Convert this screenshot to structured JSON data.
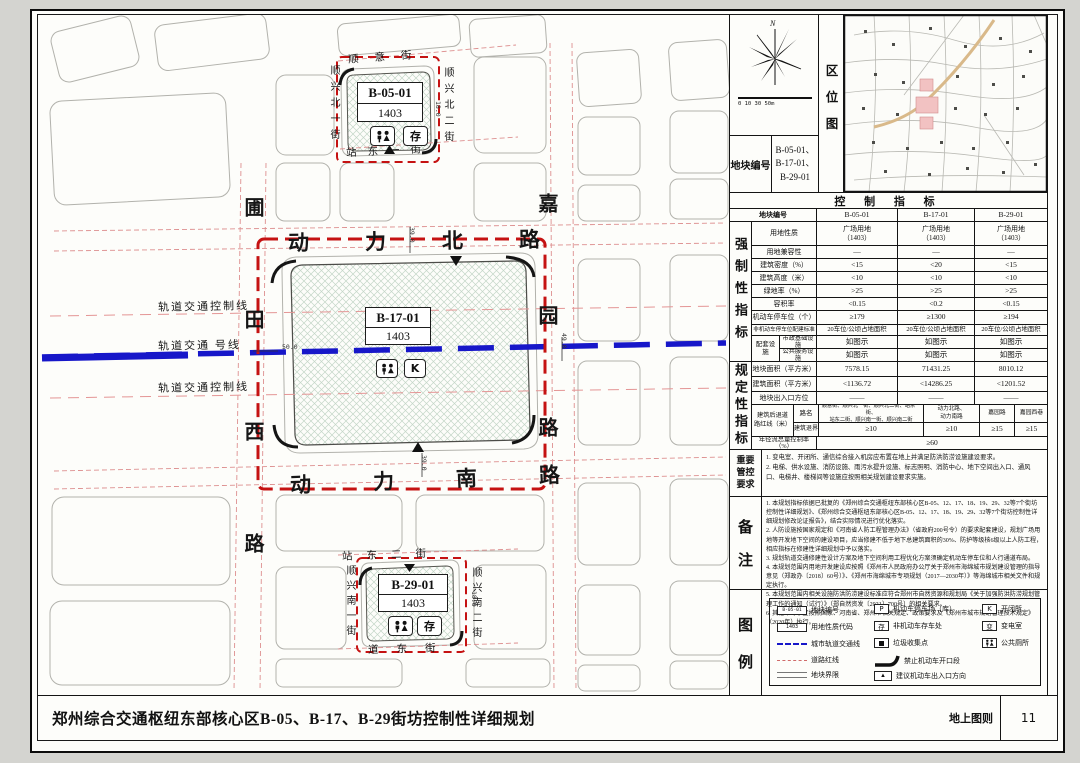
{
  "titlebar": {
    "title": "郑州综合交通枢纽东部核心区B-05、B-17、B-29街坊控制性详细规划",
    "sheet_label": "地上图则",
    "page": "11"
  },
  "compass": {
    "north_label": "N",
    "scale_text": "0  10  30  50m"
  },
  "location": {
    "panel_label": "区位图"
  },
  "block_no": {
    "label": "地块编号",
    "values": "B-05-01、\nB-17-01、\nB-29-01"
  },
  "control": {
    "title": "控  制  指  标",
    "header_label": "地块编号",
    "c1": "B-05-01",
    "c2": "B-17-01",
    "c3": "B-29-01",
    "mandatory_label": "强制性指标",
    "regulatory_label": "规定性指标",
    "r_use": {
      "label": "用地性质",
      "v1": "广场用地\n（1403）",
      "v2": "广场用地\n（1403）",
      "v3": "广场用地\n（1403）"
    },
    "r_compat": {
      "label": "用地兼容性",
      "v1": "—",
      "v2": "—",
      "v3": "—"
    },
    "r_density": {
      "label": "建筑密度（%）",
      "v1": "<15",
      "v2": "<20",
      "v3": "<15"
    },
    "r_height": {
      "label": "建筑高度（米）",
      "v1": "<10",
      "v2": "<10",
      "v3": "<10"
    },
    "r_green": {
      "label": "绿地率（%）",
      "v1": ">25",
      "v2": ">25",
      "v3": ">25"
    },
    "r_far": {
      "label": "容积率",
      "v1": "<0.15",
      "v2": "<0.2",
      "v3": "<0.15"
    },
    "r_parking": {
      "label": "机动车停车位（个）",
      "v1": "≥179",
      "v2": "≥1300",
      "v3": "≥194"
    },
    "r_bike": {
      "label": "非机动车停车位配建标准",
      "v1": "20车位/公顷占地面积",
      "v2": "20车位/公顷占地面积",
      "v3": "20车位/公顷占地面积"
    },
    "peitao_label": "配套设施",
    "r_muni": {
      "label": "市政基础设施",
      "v1": "如图示",
      "v2": "如图示",
      "v3": "如图示"
    },
    "r_public": {
      "label": "公共服务设施",
      "v1": "如图示",
      "v2": "如图示",
      "v3": "如图示"
    },
    "r_area": {
      "label": "地块面积（平方米）",
      "v1": "7578.15",
      "v2": "71431.25",
      "v3": "8010.12"
    },
    "r_floor": {
      "label": "建筑面积（平方米）",
      "v1": "<1136.72",
      "v2": "<14286.25",
      "v3": "<1201.52"
    },
    "r_access": {
      "label": "地块出入口方位",
      "v1": "——",
      "v2": "——",
      "v3": "——"
    },
    "setback_label": "建筑后退道路红线（米）",
    "setback_r1": "路名",
    "setback_r2": "建筑退界",
    "roads1": "顺意街、顺兴北一街、顺兴北二街、站东一街、\n站东二街、顺兴南一街、顺兴南二街",
    "roads2": "动力北路、\n动力南路",
    "roads3": "嘉园路",
    "roads4": "嘉园西巷",
    "sb1": "≥10",
    "sb2": "≥10",
    "sb3": "≥15",
    "sb4": "≥15",
    "runoff_label": "年径流总量控制率（%）",
    "runoff_value": "≥60"
  },
  "requirements": {
    "l1": "重要",
    "l2": "管控",
    "l3": "要求",
    "text": "1. 变电室、开闭所、通信综合接入机房应布置在地上并满足防洪防涝设施建设要求。\n2. 电梯、供水设施、消防设施、雨污水提升设施、标志照明、消防中心、地下空间出入口、通风口、电梯井、楼梯间等设施应按照相关规划建设要求实施。"
  },
  "notes": {
    "l1": "备",
    "l2": "注",
    "text": "1. 本规划指标依据已批复的《郑州综合交通枢纽东部核心区B-05、12、17、18、19、29、32等7个街坊控制性详细规划》、《郑州综合交通枢纽东部核心区B-05、12、17、18、19、29、32等7个街坊控制性详细规划修改论证报告》，结合实际情况进行优化落实。\n2. 人防设施按国家规定和《河南省人防工程管理办法》（省政府200号令）的要求配套建设，规划广场用地等开发地下空间的建设项目，应当修建不低于地下总建筑面积的30%、防护等级核6级以上人防工程，相应指标在修建性详细规划中予以落实。\n3. 规划轨道交通修建性设计方案及地下空间利用工程优化方案须确定机动车停车位和人行通道布局。\n4. 本规划范围内用地开发建设应按照《郑州市人民政府办公厅关于郑州市海绵城市规划建设管理的指导意见（郑政办〔2018〕60号）》、《郑州市海绵城市专项规划（2017—2030年）》等海绵城市相关文件和规定执行。\n5. 本规划范围内相关设施防洪防涝建设标准应符合郑州市自然资源和规划局《关于加强防洪防涝规划管理工作的通知（试行）》（郑自然资发〔2021〕700号）的相关要求。\n6. 其他未尽事宜按照国家、河南省、郑州市相关规定、政策要求及《郑州市城市规划管理技术规定》（2020年）执行。"
  },
  "legend": {
    "l1": "图",
    "l2": "例",
    "b_id": {
      "glyph": "B-05-01",
      "label": "地块编号"
    },
    "b_code": {
      "glyph": "1403",
      "label": "用地性质代码"
    },
    "rail": {
      "label": "城市轨道交通线"
    },
    "redline": {
      "label": "道路红线"
    },
    "boundary": {
      "label": "地块界限"
    },
    "park": {
      "glyph": "P",
      "label": "机动车停车场（库）"
    },
    "bike": {
      "glyph": "存",
      "label": "非机动车存车处"
    },
    "trash": {
      "label": "垃圾收集点"
    },
    "noopen": {
      "label": "禁止机动车开口段"
    },
    "entry": {
      "glyph": "▲",
      "label": "建议机动车出入口方向"
    },
    "kaibi": {
      "glyph": "K",
      "label": "开闭所"
    },
    "trans": {
      "glyph": "变",
      "label": "变电室"
    },
    "wc": {
      "label": "公共厕所"
    }
  },
  "map": {
    "b05_id": "B-05-01",
    "b05_code": "1403",
    "b17_id": "B-17-01",
    "b17_code": "1403",
    "b29_id": "B-29-01",
    "b29_code": "1403",
    "icon_bike": "存",
    "icon_k": "K",
    "road_dongli_n": "动力北路",
    "road_dongli_s": "动力南路",
    "road_putian_w": "圃田西路",
    "road_jiayuan": "嘉园路",
    "road_shunyi": "顺意街",
    "road_sx_n1": "顺兴北一街",
    "road_sx_n2": "顺兴北二街",
    "road_zd1": "站东一街",
    "road_zd2": "站东二街",
    "road_dd": "道东街",
    "road_sx_s1": "顺兴南一街",
    "road_sx_s2": "顺兴南二街",
    "rail_ctrl": "轨道交通控制线",
    "rail_line": "轨道交通  号线",
    "dim_n": "39.0",
    "dim_s": "39.0",
    "dim_rail": "50.0",
    "dim_e": "49.0",
    "dim_b05": "18.0",
    "dim_b29": "18.0"
  }
}
